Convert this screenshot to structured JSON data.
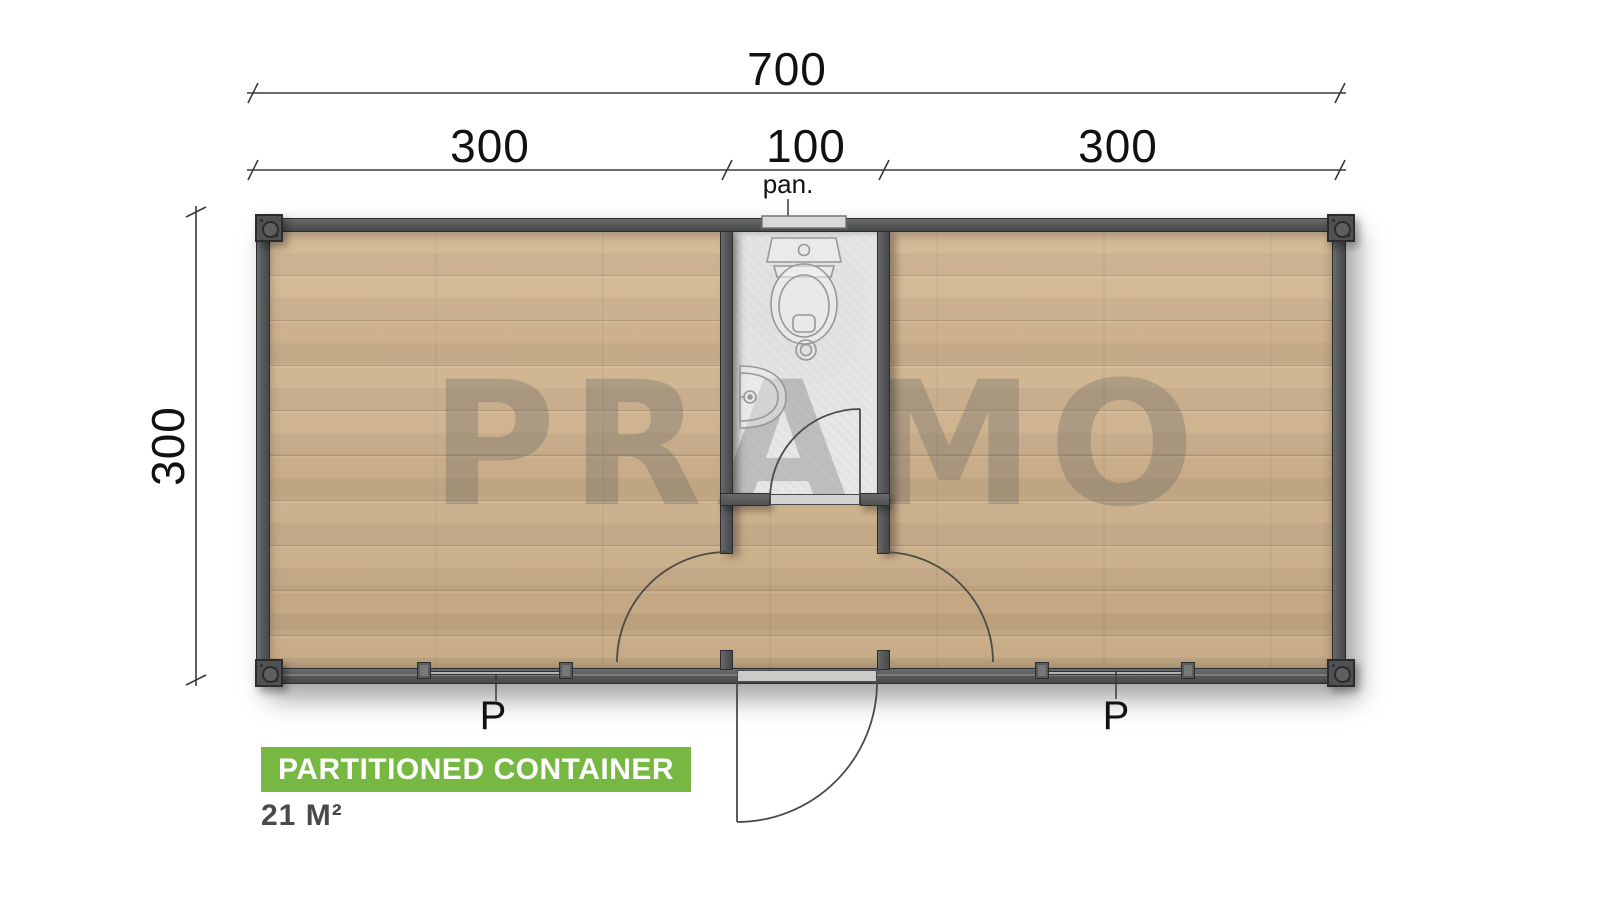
{
  "plan": {
    "watermark": "PRAMO",
    "dims": {
      "total_width": "700",
      "left_room": "300",
      "middle": "100",
      "right_room": "300",
      "depth": "300"
    },
    "labels": {
      "panel": "pan.",
      "window_left": "P",
      "window_right": "P"
    },
    "footer": {
      "title": "PARTITIONED CONTAINER",
      "area": "21 M²"
    },
    "colors": {
      "badge_green": "#77b843",
      "wall_gray": "#57585a",
      "wood_floor": "#d2b58f",
      "bathroom_floor": "#e7e7e5"
    }
  }
}
